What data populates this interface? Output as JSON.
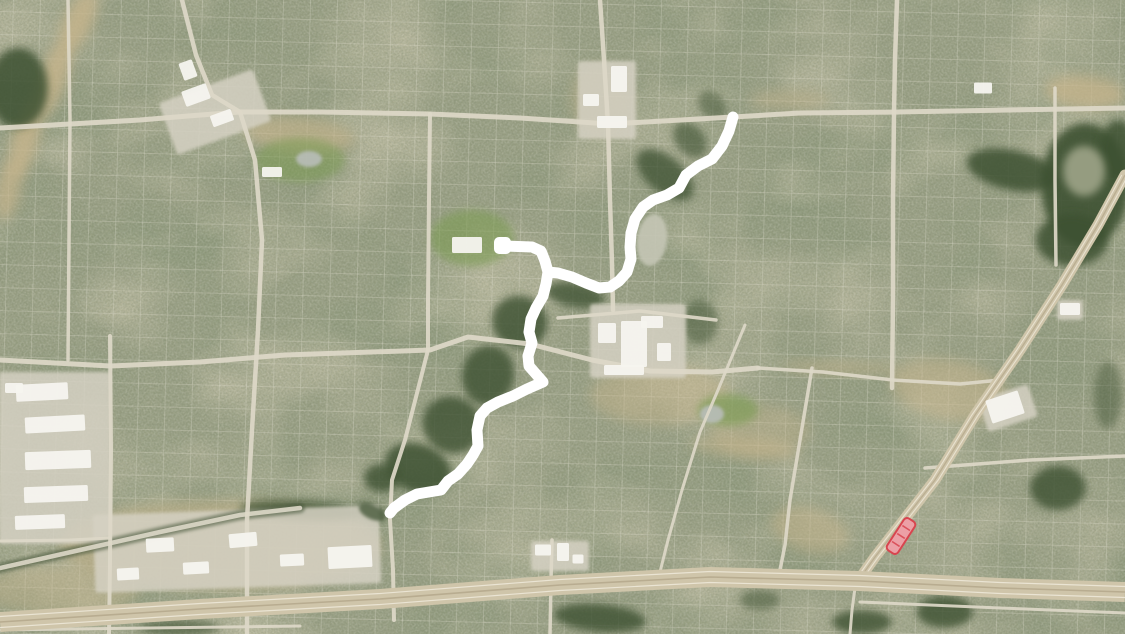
{
  "scene": {
    "kind": "satellite-map-with-route-overlay",
    "width": 1125,
    "height": 634
  },
  "palette": {
    "base": "#9AA084",
    "speckle_dark": "#313A29",
    "speckle_light": "#EDE9DB",
    "mottle_tan": "#C2B084",
    "mottle_green": "#3D4D2E",
    "forest": "#3E5132",
    "field_tan": "#C7B58C",
    "park_green": "#7C9B53",
    "pond_pale": "#C5C6B5",
    "pond_gray": "#B9BEB9",
    "pond_dark": "#59684C",
    "road": "#DDD8C8",
    "highway": "#CFC5AA",
    "highway_stripe": "#EFE9DA",
    "highway_median": "#B5A98D",
    "tree_line": "#46573A",
    "commercial": "#D5D1C3",
    "building": "#F5F4EF",
    "route": "#FFFFFF",
    "highlight_fill": "#ECA0A6",
    "highlight_stroke": "#D8454F"
  },
  "terrain": {
    "fields": [
      [
        78,
        22,
        14,
        34,
        25,
        0.8
      ],
      [
        52,
        80,
        14,
        40,
        20,
        0.8
      ],
      [
        25,
        140,
        13,
        40,
        15,
        0.8
      ],
      [
        8,
        190,
        12,
        30,
        10,
        0.7
      ],
      [
        300,
        135,
        55,
        18,
        5,
        0.6
      ],
      [
        1085,
        92,
        40,
        16,
        5,
        0.75
      ],
      [
        660,
        395,
        70,
        30,
        0,
        0.45
      ],
      [
        760,
        430,
        50,
        25,
        0,
        0.35
      ],
      [
        950,
        390,
        60,
        30,
        10,
        0.5
      ],
      [
        220,
        545,
        160,
        45,
        0,
        0.55
      ],
      [
        60,
        590,
        80,
        25,
        0,
        0.4
      ],
      [
        810,
        530,
        40,
        22,
        15,
        0.5
      ],
      [
        600,
        100,
        30,
        35,
        0,
        0.35
      ],
      [
        790,
        100,
        40,
        10,
        0,
        0.4
      ],
      [
        745,
        448,
        55,
        10,
        5,
        0.5
      ],
      [
        840,
        368,
        60,
        6,
        2,
        0.5
      ]
    ],
    "parks": [
      [
        300,
        160,
        45,
        22,
        0,
        0.55
      ],
      [
        472,
        238,
        42,
        28,
        0,
        0.6
      ],
      [
        728,
        410,
        30,
        16,
        0,
        0.65
      ]
    ],
    "forests": [
      [
        18,
        88,
        30,
        40,
        0,
        0.85
      ],
      [
        520,
        322,
        28,
        26,
        20,
        0.8
      ],
      [
        488,
        375,
        26,
        30,
        10,
        0.8
      ],
      [
        452,
        425,
        30,
        28,
        30,
        0.8
      ],
      [
        418,
        468,
        34,
        24,
        20,
        0.85
      ],
      [
        382,
        478,
        18,
        14,
        0,
        0.8
      ],
      [
        575,
        295,
        30,
        12,
        10,
        0.75
      ],
      [
        665,
        175,
        34,
        18,
        40,
        0.75
      ],
      [
        690,
        140,
        20,
        14,
        50,
        0.6
      ],
      [
        712,
        105,
        16,
        12,
        45,
        0.5
      ],
      [
        1085,
        185,
        44,
        62,
        0,
        0.9
      ],
      [
        1012,
        170,
        46,
        20,
        12,
        0.85
      ],
      [
        1072,
        240,
        36,
        26,
        0,
        0.85
      ],
      [
        1118,
        150,
        18,
        30,
        0,
        0.85
      ],
      [
        1108,
        395,
        14,
        34,
        0,
        0.45
      ],
      [
        1058,
        488,
        28,
        22,
        0,
        0.8
      ],
      [
        600,
        618,
        46,
        14,
        5,
        0.8
      ],
      [
        862,
        622,
        30,
        12,
        0,
        0.8
      ],
      [
        945,
        612,
        28,
        16,
        0,
        0.8
      ],
      [
        300,
        510,
        60,
        10,
        3,
        0.7
      ],
      [
        180,
        628,
        40,
        8,
        0,
        0.6
      ],
      [
        760,
        600,
        20,
        10,
        0,
        0.5
      ],
      [
        370,
        512,
        16,
        8,
        20,
        0.75
      ],
      [
        700,
        322,
        18,
        22,
        0,
        0.5
      ]
    ],
    "clearings": [
      [
        1084,
        171,
        21,
        25,
        0,
        0.95
      ]
    ],
    "ponds": [
      {
        "cx": 652,
        "cy": 240,
        "rx": 15,
        "ry": 26,
        "rot": 8,
        "fill": "pond_pale"
      },
      {
        "cx": 309,
        "cy": 159,
        "rx": 13,
        "ry": 8,
        "rot": 0,
        "fill": "pond_gray"
      },
      {
        "cx": 712,
        "cy": 414,
        "rx": 12,
        "ry": 9,
        "rot": 0,
        "fill": "pond_gray"
      },
      {
        "cx": 372,
        "cy": 512,
        "rx": 14,
        "ry": 7,
        "rot": 25,
        "fill": "pond_dark"
      }
    ]
  },
  "roads": [
    {
      "name": "arterial-north",
      "width": 5,
      "pts": [
        [
          0,
          128
        ],
        [
          70,
          124
        ],
        [
          140,
          120
        ],
        [
          188,
          116
        ],
        [
          240,
          112
        ],
        [
          320,
          112
        ],
        [
          430,
          114
        ],
        [
          520,
          118
        ],
        [
          610,
          124
        ],
        [
          733,
          117
        ],
        [
          800,
          113
        ],
        [
          897,
          112
        ],
        [
          1010,
          110
        ],
        [
          1125,
          108
        ]
      ]
    },
    {
      "name": "arterial-middle",
      "width": 5,
      "pts": [
        [
          0,
          360
        ],
        [
          110,
          366
        ],
        [
          200,
          362
        ],
        [
          285,
          355
        ],
        [
          430,
          350
        ],
        [
          468,
          337
        ],
        [
          530,
          344
        ],
        [
          592,
          360
        ],
        [
          650,
          371
        ],
        [
          712,
          372
        ],
        [
          758,
          368
        ]
      ]
    },
    {
      "name": "mall-north-road",
      "width": 3.5,
      "pts": [
        [
          558,
          318
        ],
        [
          640,
          311
        ],
        [
          716,
          320
        ]
      ]
    },
    {
      "name": "east-road",
      "width": 3.5,
      "pts": [
        [
          758,
          368
        ],
        [
          823,
          372
        ],
        [
          893,
          380
        ],
        [
          960,
          384
        ],
        [
          1000,
          380
        ]
      ]
    },
    {
      "name": "east-cross-road",
      "width": 3.5,
      "pts": [
        [
          925,
          468
        ],
        [
          1030,
          460
        ],
        [
          1125,
          456
        ]
      ]
    },
    {
      "name": "west-short-road",
      "width": 3,
      "pts": [
        [
          0,
          541
        ],
        [
          70,
          540
        ],
        [
          110,
          538
        ]
      ]
    },
    {
      "name": "frontage-road",
      "width": 3,
      "pts": [
        [
          860,
          602
        ],
        [
          1000,
          608
        ],
        [
          1125,
          613
        ]
      ]
    },
    {
      "name": "bottom-left-road",
      "width": 3,
      "pts": [
        [
          0,
          630
        ],
        [
          150,
          628
        ],
        [
          300,
          626
        ]
      ]
    },
    {
      "name": "vertical-west",
      "width": 3.5,
      "pts": [
        [
          68,
          0
        ],
        [
          70,
          120
        ],
        [
          69,
          240
        ],
        [
          68,
          360
        ]
      ]
    },
    {
      "name": "vertical-west-lower",
      "width": 4,
      "pts": [
        [
          110,
          336
        ],
        [
          111,
          450
        ],
        [
          110,
          560
        ],
        [
          109,
          634
        ]
      ]
    },
    {
      "name": "vertical-nw-upper",
      "width": 4.5,
      "pts": [
        [
          182,
          0
        ],
        [
          196,
          55
        ],
        [
          212,
          95
        ],
        [
          240,
          112
        ]
      ]
    },
    {
      "name": "vertical-nw-lower",
      "width": 4.5,
      "pts": [
        [
          240,
          112
        ],
        [
          255,
          160
        ],
        [
          262,
          240
        ],
        [
          258,
          330
        ],
        [
          252,
          430
        ],
        [
          247,
          520
        ],
        [
          247,
          634
        ]
      ]
    },
    {
      "name": "vertical-center-west",
      "width": 4,
      "pts": [
        [
          430,
          114
        ],
        [
          429,
          200
        ],
        [
          428,
          300
        ],
        [
          428,
          350
        ],
        [
          405,
          440
        ],
        [
          392,
          480
        ],
        [
          390,
          520
        ],
        [
          393,
          570
        ],
        [
          394,
          620
        ]
      ]
    },
    {
      "name": "vertical-center",
      "width": 4.5,
      "pts": [
        [
          600,
          0
        ],
        [
          604,
          60
        ],
        [
          608,
          124
        ],
        [
          610,
          200
        ],
        [
          612,
          264
        ],
        [
          613,
          310
        ]
      ]
    },
    {
      "name": "diagonal-local-a",
      "width": 3,
      "pts": [
        [
          745,
          325
        ],
        [
          718,
          390
        ],
        [
          700,
          432
        ],
        [
          682,
          490
        ],
        [
          668,
          540
        ],
        [
          660,
          572
        ]
      ]
    },
    {
      "name": "diagonal-local-b",
      "width": 3.5,
      "pts": [
        [
          812,
          368
        ],
        [
          800,
          440
        ],
        [
          790,
          500
        ],
        [
          785,
          545
        ],
        [
          780,
          570
        ]
      ]
    },
    {
      "name": "vertical-east",
      "width": 4.5,
      "pts": [
        [
          897,
          0
        ],
        [
          895,
          60
        ],
        [
          894,
          112
        ],
        [
          893,
          200
        ],
        [
          893,
          300
        ],
        [
          892,
          388
        ]
      ]
    },
    {
      "name": "vertical-far-east",
      "width": 3.5,
      "pts": [
        [
          1055,
          88
        ],
        [
          1055,
          180
        ],
        [
          1056,
          265
        ]
      ]
    },
    {
      "name": "vertical-freeway-south",
      "width": 3,
      "pts": [
        [
          855,
          588
        ],
        [
          852,
          610
        ],
        [
          850,
          634
        ]
      ]
    },
    {
      "name": "overpass-road",
      "width": 3.5,
      "pts": [
        [
          552,
          540
        ],
        [
          551,
          580
        ],
        [
          550,
          634
        ]
      ]
    }
  ],
  "tree_lined_road": {
    "name": "creek-road",
    "width": 4.5,
    "edge_width": 10,
    "pts": [
      [
        0,
        568
      ],
      [
        80,
        550
      ],
      [
        160,
        532
      ],
      [
        240,
        515
      ],
      [
        300,
        508
      ]
    ]
  },
  "diagonal_highway": {
    "name": "diagonal-highway",
    "width": 11,
    "pts": [
      [
        1125,
        175
      ],
      [
        1098,
        225
      ],
      [
        1062,
        285
      ],
      [
        1020,
        350
      ],
      [
        975,
        415
      ],
      [
        935,
        480
      ],
      [
        900,
        525
      ],
      [
        875,
        557
      ],
      [
        858,
        581
      ]
    ]
  },
  "freeway": {
    "name": "freeway",
    "width": 20,
    "pts": [
      [
        0,
        622
      ],
      [
        200,
        609
      ],
      [
        380,
        599
      ],
      [
        560,
        585
      ],
      [
        710,
        577
      ],
      [
        860,
        581
      ],
      [
        1000,
        588
      ],
      [
        1125,
        592
      ]
    ]
  },
  "commercial_zones": [
    [
      607,
      100,
      58,
      78,
      0
    ],
    [
      215,
      112,
      100,
      55,
      -20
    ],
    [
      638,
      341,
      96,
      74,
      0
    ],
    [
      55,
      458,
      112,
      172,
      0
    ],
    [
      237,
      549,
      286,
      78,
      -2
    ],
    [
      560,
      556,
      58,
      30,
      0
    ],
    [
      1008,
      408,
      52,
      34,
      -18
    ],
    [
      1070,
      310,
      26,
      20,
      0
    ]
  ],
  "buildings": [
    [
      619,
      79,
      16,
      26,
      0
    ],
    [
      591,
      100,
      16,
      12,
      0
    ],
    [
      612,
      122,
      30,
      12,
      0
    ],
    [
      196,
      95,
      26,
      16,
      -20
    ],
    [
      222,
      118,
      22,
      12,
      -20
    ],
    [
      188,
      70,
      14,
      18,
      -20
    ],
    [
      467,
      245,
      30,
      16,
      0
    ],
    [
      634,
      344,
      26,
      46,
      0
    ],
    [
      607,
      333,
      18,
      20,
      0
    ],
    [
      652,
      322,
      22,
      12,
      0
    ],
    [
      624,
      370,
      40,
      10,
      0
    ],
    [
      664,
      352,
      14,
      18,
      0
    ],
    [
      42,
      392,
      52,
      17,
      -3
    ],
    [
      55,
      424,
      60,
      16,
      -3
    ],
    [
      58,
      460,
      66,
      18,
      -2
    ],
    [
      56,
      494,
      64,
      16,
      -2
    ],
    [
      40,
      522,
      50,
      14,
      -2
    ],
    [
      14,
      388,
      18,
      10,
      0
    ],
    [
      350,
      557,
      44,
      22,
      -3
    ],
    [
      243,
      540,
      28,
      14,
      -5
    ],
    [
      292,
      560,
      24,
      12,
      -3
    ],
    [
      160,
      545,
      28,
      14,
      -3
    ],
    [
      128,
      574,
      22,
      12,
      -3
    ],
    [
      196,
      568,
      26,
      12,
      -3
    ],
    [
      543,
      550,
      16,
      11,
      0
    ],
    [
      563,
      552,
      12,
      18,
      0
    ],
    [
      578,
      559,
      11,
      9,
      0
    ],
    [
      1005,
      407,
      34,
      24,
      -18
    ],
    [
      272,
      172,
      20,
      10,
      0
    ],
    [
      983,
      88,
      18,
      11,
      0
    ],
    [
      1070,
      309,
      20,
      12,
      0
    ]
  ],
  "route_overlay": {
    "stroke_width": 11,
    "main_path": [
      [
        733,
        117
      ],
      [
        729,
        131
      ],
      [
        722,
        146
      ],
      [
        712,
        159
      ],
      [
        698,
        166
      ],
      [
        686,
        175
      ],
      [
        679,
        188
      ],
      [
        667,
        195
      ],
      [
        653,
        200
      ],
      [
        643,
        207
      ],
      [
        635,
        219
      ],
      [
        631,
        233
      ],
      [
        630,
        247
      ],
      [
        631,
        259
      ],
      [
        627,
        272
      ],
      [
        619,
        281
      ],
      [
        610,
        287
      ],
      [
        599,
        288
      ],
      [
        586,
        283
      ],
      [
        572,
        277
      ],
      [
        558,
        273
      ],
      [
        548,
        272
      ],
      [
        546,
        284
      ],
      [
        543,
        296
      ],
      [
        536,
        308
      ],
      [
        531,
        319
      ],
      [
        529,
        332
      ],
      [
        532,
        343
      ],
      [
        528,
        356
      ],
      [
        529,
        366
      ],
      [
        536,
        374
      ],
      [
        543,
        382
      ],
      [
        527,
        389
      ],
      [
        513,
        396
      ],
      [
        498,
        402
      ],
      [
        487,
        408
      ],
      [
        480,
        416
      ],
      [
        477,
        430
      ],
      [
        478,
        446
      ],
      [
        473,
        455
      ],
      [
        467,
        464
      ],
      [
        458,
        474
      ],
      [
        448,
        481
      ],
      [
        441,
        490
      ],
      [
        429,
        492
      ],
      [
        417,
        494
      ],
      [
        405,
        500
      ],
      [
        394,
        508
      ],
      [
        390,
        513
      ]
    ],
    "spur_path": [
      [
        548,
        272
      ],
      [
        545,
        261
      ],
      [
        541,
        251
      ],
      [
        532,
        247
      ],
      [
        504,
        246
      ]
    ],
    "start_block": {
      "x": 494,
      "y": 237,
      "w": 17,
      "h": 17,
      "r": 5
    }
  },
  "building_highlight": {
    "cx": 901,
    "cy": 536,
    "width": 13,
    "length": 38,
    "rotation": 33,
    "stripe_count": 3
  }
}
